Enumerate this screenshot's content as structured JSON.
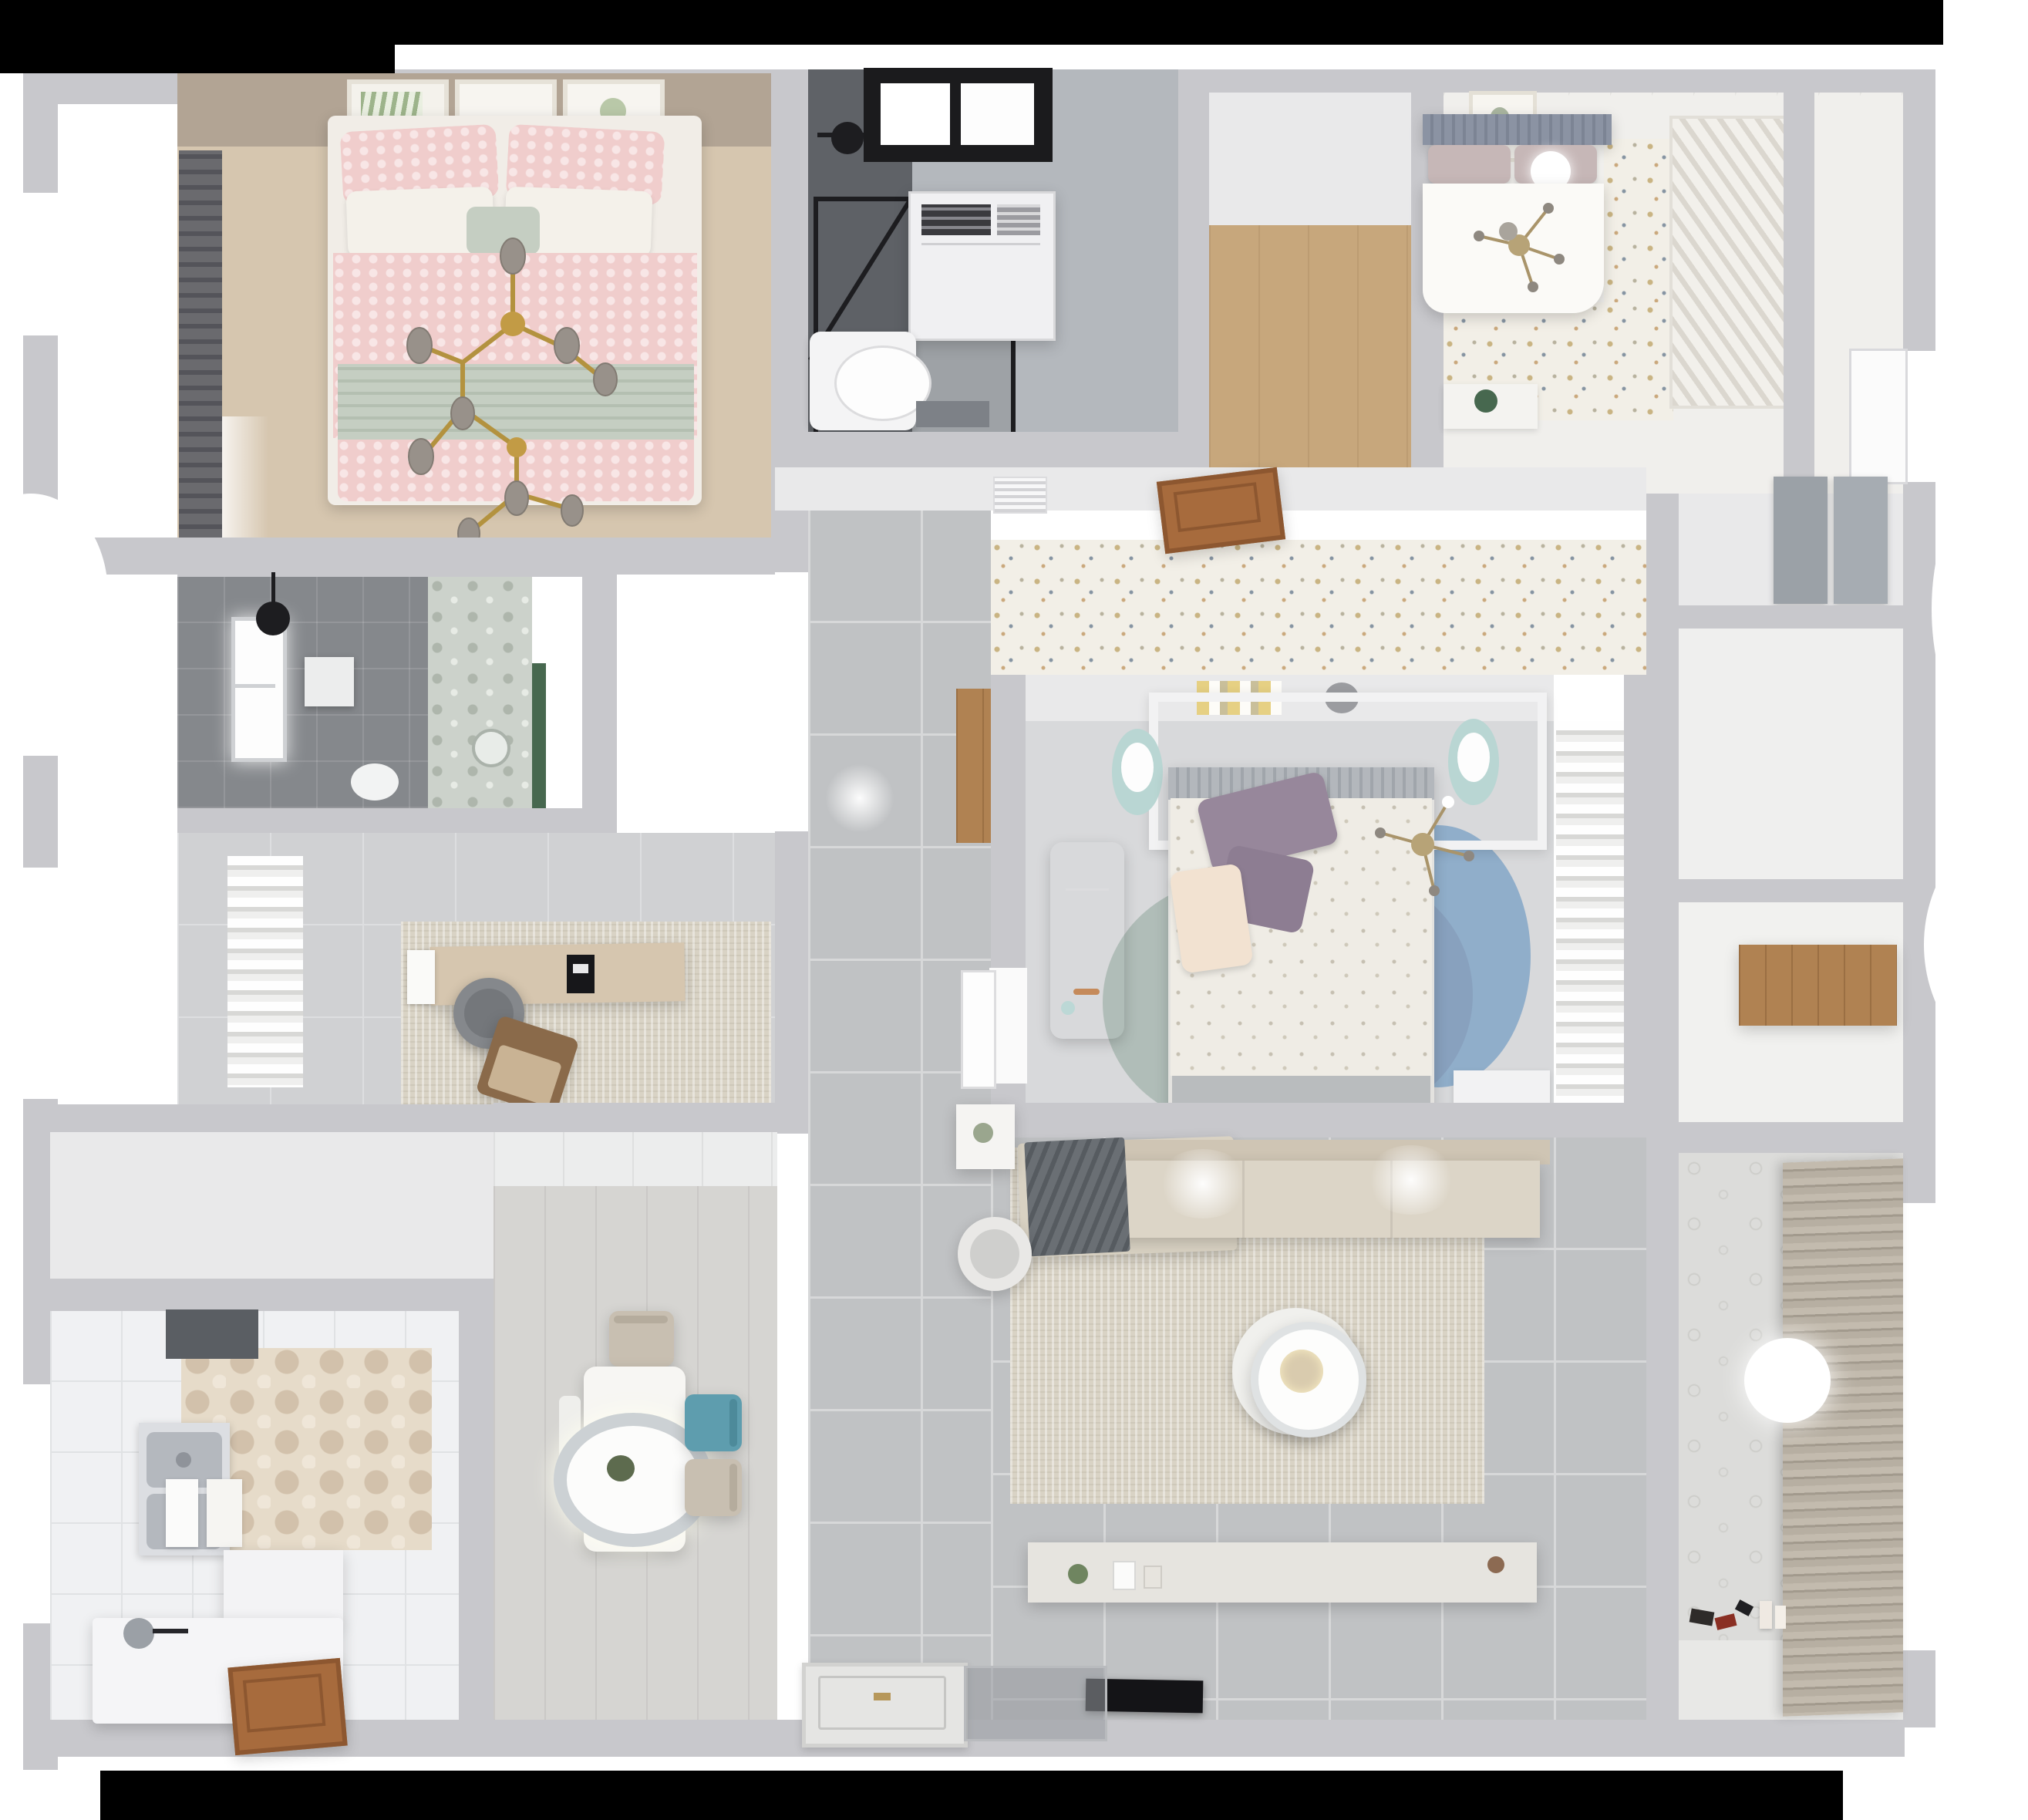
{
  "scene": {
    "type": "3d-floorplan-top-down-render",
    "description": "Photoreal dollhouse view of an apartment with two bedrooms, master bedroom, study, two bathrooms, kitchen, dining, living room and laundry balcony",
    "visible_text": []
  },
  "palette": {
    "bg": "#ffffff",
    "mask": "#000000",
    "wall": "#c8c8cc",
    "wall2": "#e9e9ea",
    "tile": "#c0c2c4",
    "grout": "#d7d8d9",
    "tile_light": "#d0d1d3",
    "kitchen_floor": "#f0f1f3",
    "wood_entry": "#c7a77c",
    "wood_door": "#a76b3d",
    "wood_shelf": "#b08252",
    "br1_floor": "#d6c6af",
    "br1_wall": "#b2a494",
    "curtain_dark": "#606064",
    "pink": "#f0cdcc",
    "sage": "#c5cec2",
    "gold": "#b3923f",
    "bulb": "#98918a",
    "bath1_floor": "#b4b8bd",
    "bath_dark": "#5f6267",
    "frame_black": "#1b1b1d",
    "speckle_bg": "#f2efe7",
    "headboard": "#8b93a3",
    "mauve": "#c6b7b7",
    "duvet": "#fbfaf7",
    "master_floor": "#d8d9db",
    "duvet2": "#efece5",
    "purple": "#97879b",
    "cream": "#f2e2d1",
    "rug_teal": "#a9b7b2",
    "rug_mauve": "#a98f98",
    "rug_blue": "#7ea3c6",
    "stool_teal": "#b9d6d3",
    "sofa": "#d9d2c3",
    "sofa_seat": "#dcd5c7",
    "blanket": "#6a6f74",
    "rug_living": "#d9d3c5",
    "console": "#e6e4df",
    "tv": "#141417",
    "dine_floor": "#d6d5d2",
    "chair_teal": "#5e9dae",
    "chair_beige": "#c8bfb1",
    "lamp_ring": "#ccd1d4",
    "steel": "#b4b8be",
    "laundry_wall": "#dcdcda",
    "floral": "#ccd2cb",
    "bath2_floor": "#85888c",
    "green": "#47684f"
  },
  "rooms": [
    {
      "id": "bedroom-1",
      "label": "pink bedroom",
      "furniture": [
        "double-bed-pink",
        "wall-frames",
        "dark-curtain",
        "branch-chandelier"
      ]
    },
    {
      "id": "bathroom-1",
      "label": "shower bathroom",
      "furniture": [
        "shower-enclosure",
        "window",
        "washer-cabinet",
        "toilet",
        "bath-mat"
      ]
    },
    {
      "id": "entry-closet",
      "label": "wood floor closet",
      "furniture": []
    },
    {
      "id": "bedroom-2",
      "label": "guest bedroom",
      "furniture": [
        "bed-gray-headboard",
        "ball-lamp",
        "louver-wardrobe",
        "plant-console",
        "cross-lamp"
      ]
    },
    {
      "id": "bathroom-2",
      "label": "dark tiled bathroom",
      "furniture": [
        "window",
        "shower-head",
        "toilet",
        "round-mirror"
      ]
    },
    {
      "id": "study",
      "label": "study room",
      "furniture": [
        "curtains",
        "desk",
        "monitor",
        "office-chair",
        "lounge-chair",
        "rug",
        "door-mat"
      ]
    },
    {
      "id": "master-bedroom",
      "label": "master bedroom",
      "furniture": [
        "bed-floral",
        "headboard-shelf",
        "books",
        "two-stools",
        "desk-white",
        "round-rugs",
        "curtains",
        "cross-lamp"
      ]
    },
    {
      "id": "living-room",
      "label": "living room",
      "furniture": [
        "l-sofa",
        "gray-blanket",
        "rug",
        "round-coffee-table",
        "armchair",
        "side-table",
        "tv-console",
        "tv"
      ]
    },
    {
      "id": "dining",
      "label": "dining area",
      "furniture": [
        "table",
        "pendant-lamp",
        "chair-beige",
        "chair-teal",
        "chair-beige-2",
        "bench"
      ]
    },
    {
      "id": "kitchen",
      "label": "kitchen",
      "furniture": [
        "range-hood",
        "hex-tile-floor",
        "double-sink",
        "cutting-boards",
        "l-counter",
        "faucet",
        "wood-door",
        "window"
      ]
    },
    {
      "id": "laundry-balcony",
      "label": "laundry balcony",
      "furniture": [
        "roman-blinds",
        "ceiling-light",
        "toys",
        "bottles"
      ]
    },
    {
      "id": "storage-nook",
      "label": "storage nook",
      "furniture": [
        "wood-shelf"
      ]
    },
    {
      "id": "upper-closet",
      "label": "closet with gray panels",
      "furniture": [
        "gray-panel-1",
        "gray-panel-2"
      ]
    },
    {
      "id": "hallway",
      "label": "tiled hallway",
      "furniture": [
        "ac-vent",
        "open-wood-door",
        "front-door-leaf",
        "glass-panel"
      ]
    }
  ]
}
